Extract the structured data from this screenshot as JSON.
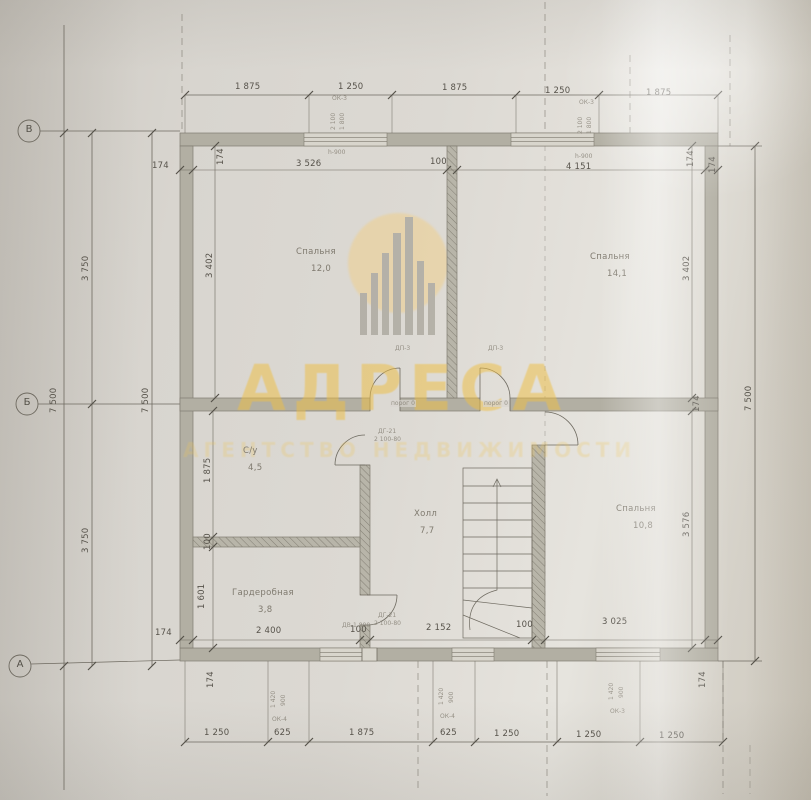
{
  "watermark": {
    "title": "АДРЕСА",
    "subtitle": "АГЕНТСТВО НЕДВИЖИМОСТИ"
  },
  "axes": {
    "v": "В",
    "b": "Б",
    "a": "А"
  },
  "rooms": {
    "bedroom1": {
      "name": "Спальня",
      "area": "12,0"
    },
    "bedroom2": {
      "name": "Спальня",
      "area": "14,1"
    },
    "bathroom": {
      "name": "С/у",
      "area": "4,5"
    },
    "wardrobe": {
      "name": "Гардеробная",
      "area": "3,8"
    },
    "hall": {
      "name": "Холл",
      "area": "7,7"
    },
    "bedroom3": {
      "name": "Спальня",
      "area": "10,8"
    }
  },
  "dims": {
    "top_outer": [
      "1 875",
      "1 250",
      "1 875",
      "1 250",
      "1 875"
    ],
    "top_inner": {
      "left_wall": "174",
      "room1": "3 526",
      "partition": "100",
      "room2": "4 151"
    },
    "bottom_inner": {
      "left_wall": "174",
      "wardrobe": "2 400",
      "partition1": "100",
      "hall": "2 152",
      "partition2": "100",
      "bedroom": "3 025"
    },
    "bottom_outer": [
      "1 250",
      "625",
      "1 875",
      "625",
      "1 250",
      "1 250",
      "1 250"
    ],
    "left_total_outer": "7 500",
    "left_half_top": "3 750",
    "left_half_bottom": "3 750",
    "left_total_inner": "7 500",
    "right_total": "7 500",
    "left_room1": "3 402",
    "left_bath": "1 875",
    "left_wall_mid": "100",
    "left_wardrobe": "1 601",
    "right_room2": "3 402",
    "right_bedroom3": "3 576",
    "wall": "174"
  },
  "annotations": {
    "door_label": "ДП-3",
    "threshold": "порог 0",
    "win_top": "ОК-3",
    "win_spec_a": "2 100",
    "win_spec_b": "1 800",
    "sill": "h-900",
    "win_bot_small": "ОК-4",
    "win_bot_big": "ОК-3",
    "win_bot_spec_a": "1 420",
    "win_bot_spec_b": "900",
    "door_spec_1": "ДГ-21",
    "door_spec_2": "2 100-80",
    "entry_door": "ДВ-1 800"
  },
  "colors": {
    "watermark": "#eebf45",
    "paper": "#d9d6d0",
    "wall_fill": "#b2afa3",
    "line": "#6e6a60"
  }
}
